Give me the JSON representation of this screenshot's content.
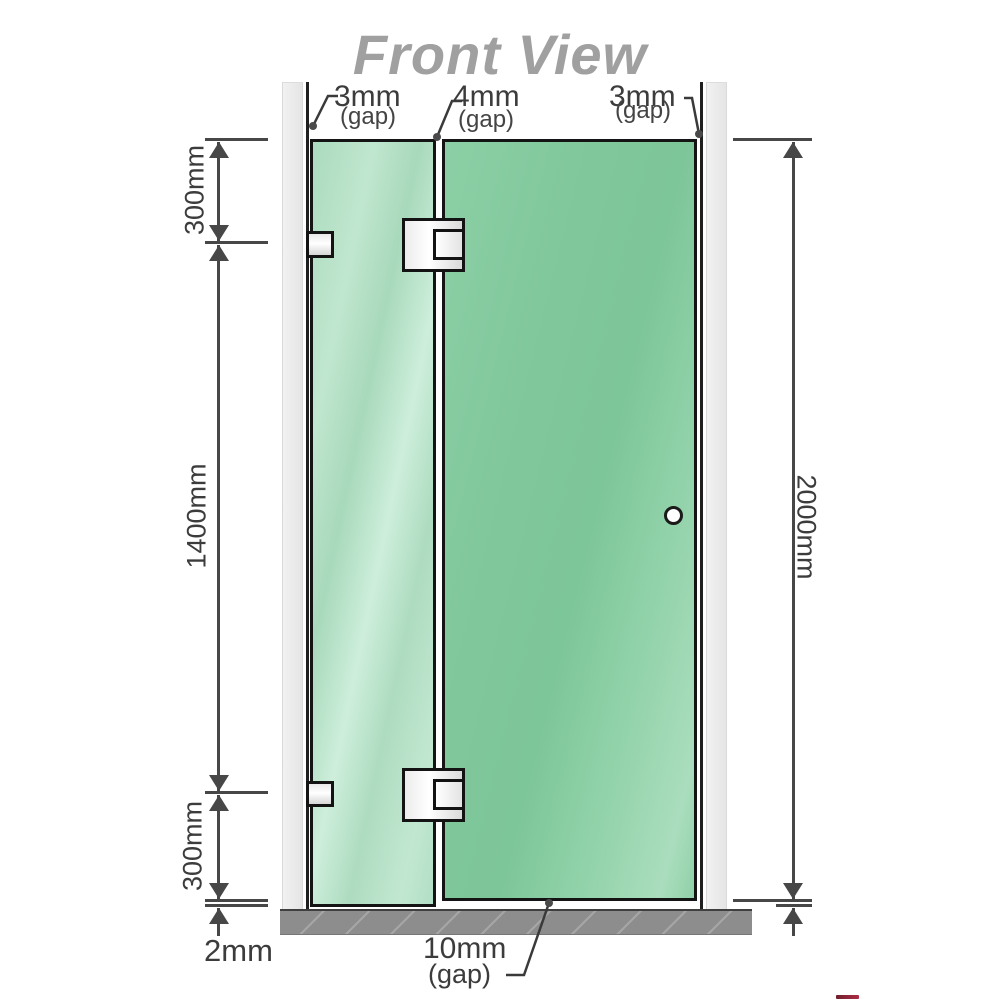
{
  "title": "Front View",
  "labels": {
    "gap_top_left": {
      "value": "3mm",
      "qualifier": "(gap)"
    },
    "gap_top_center": {
      "value": "4mm",
      "qualifier": "(gap)"
    },
    "gap_top_right": {
      "value": "3mm",
      "qualifier": "(gap)"
    },
    "segment_top": "300mm",
    "segment_middle": "1400mm",
    "segment_bottom": "300mm",
    "floor_clearance": "2mm",
    "overall_height": "2000mm",
    "gap_bottom": {
      "value": "10mm",
      "qualifier": "(gap)"
    }
  },
  "colors": {
    "title_gray": "#a0a0a0",
    "glass_fixed_green": "#b2dfc5",
    "glass_door_green": "#83ca9f",
    "dimension_gray": "#474747",
    "wall_channel_gray": "#ececec",
    "floor_gray": "#8d8d8d",
    "hardware_outline": "#131313",
    "logo_red": "#8e1127"
  }
}
